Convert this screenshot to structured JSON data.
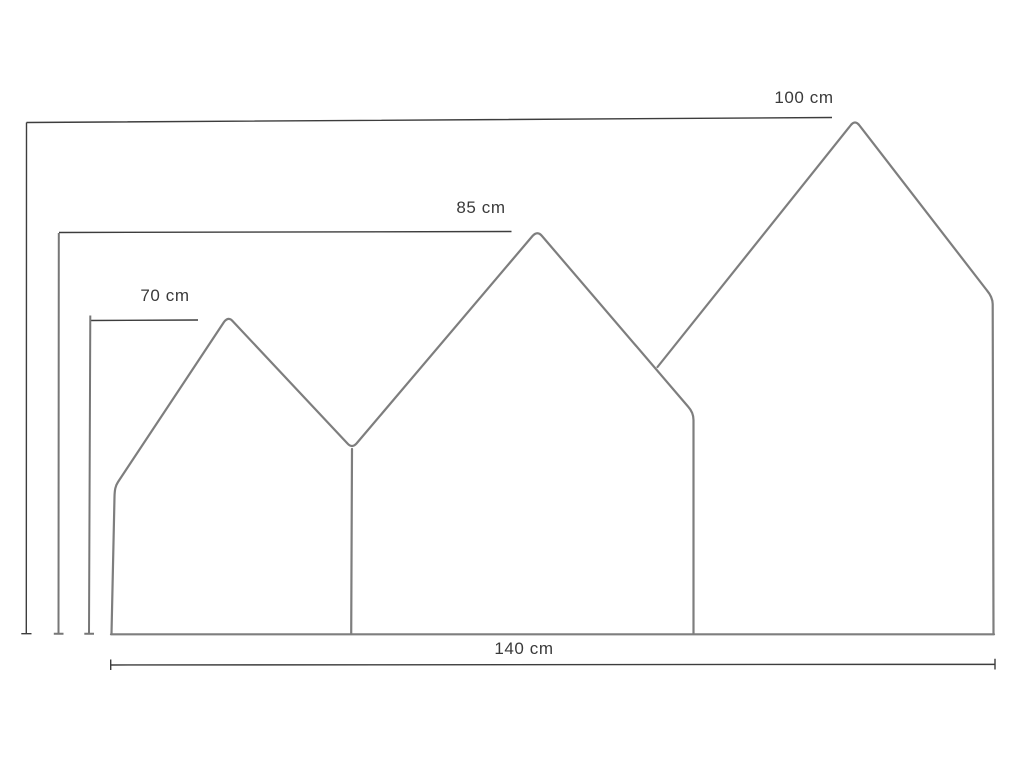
{
  "diagram": {
    "background": "#ffffff",
    "colors": {
      "outline": "#7e7e7e",
      "dimension": "#3d3d3d",
      "dimension_gray": "#777777",
      "text": "#3a3a3a"
    },
    "dimensions": {
      "largest_height": {
        "label": "100 cm",
        "value_cm": 100
      },
      "middle_height": {
        "label": "85 cm",
        "value_cm": 85
      },
      "smallest_height": {
        "label": "70 cm",
        "value_cm": 70
      },
      "total_width": {
        "label": "140 cm",
        "value_cm": 140
      }
    }
  }
}
